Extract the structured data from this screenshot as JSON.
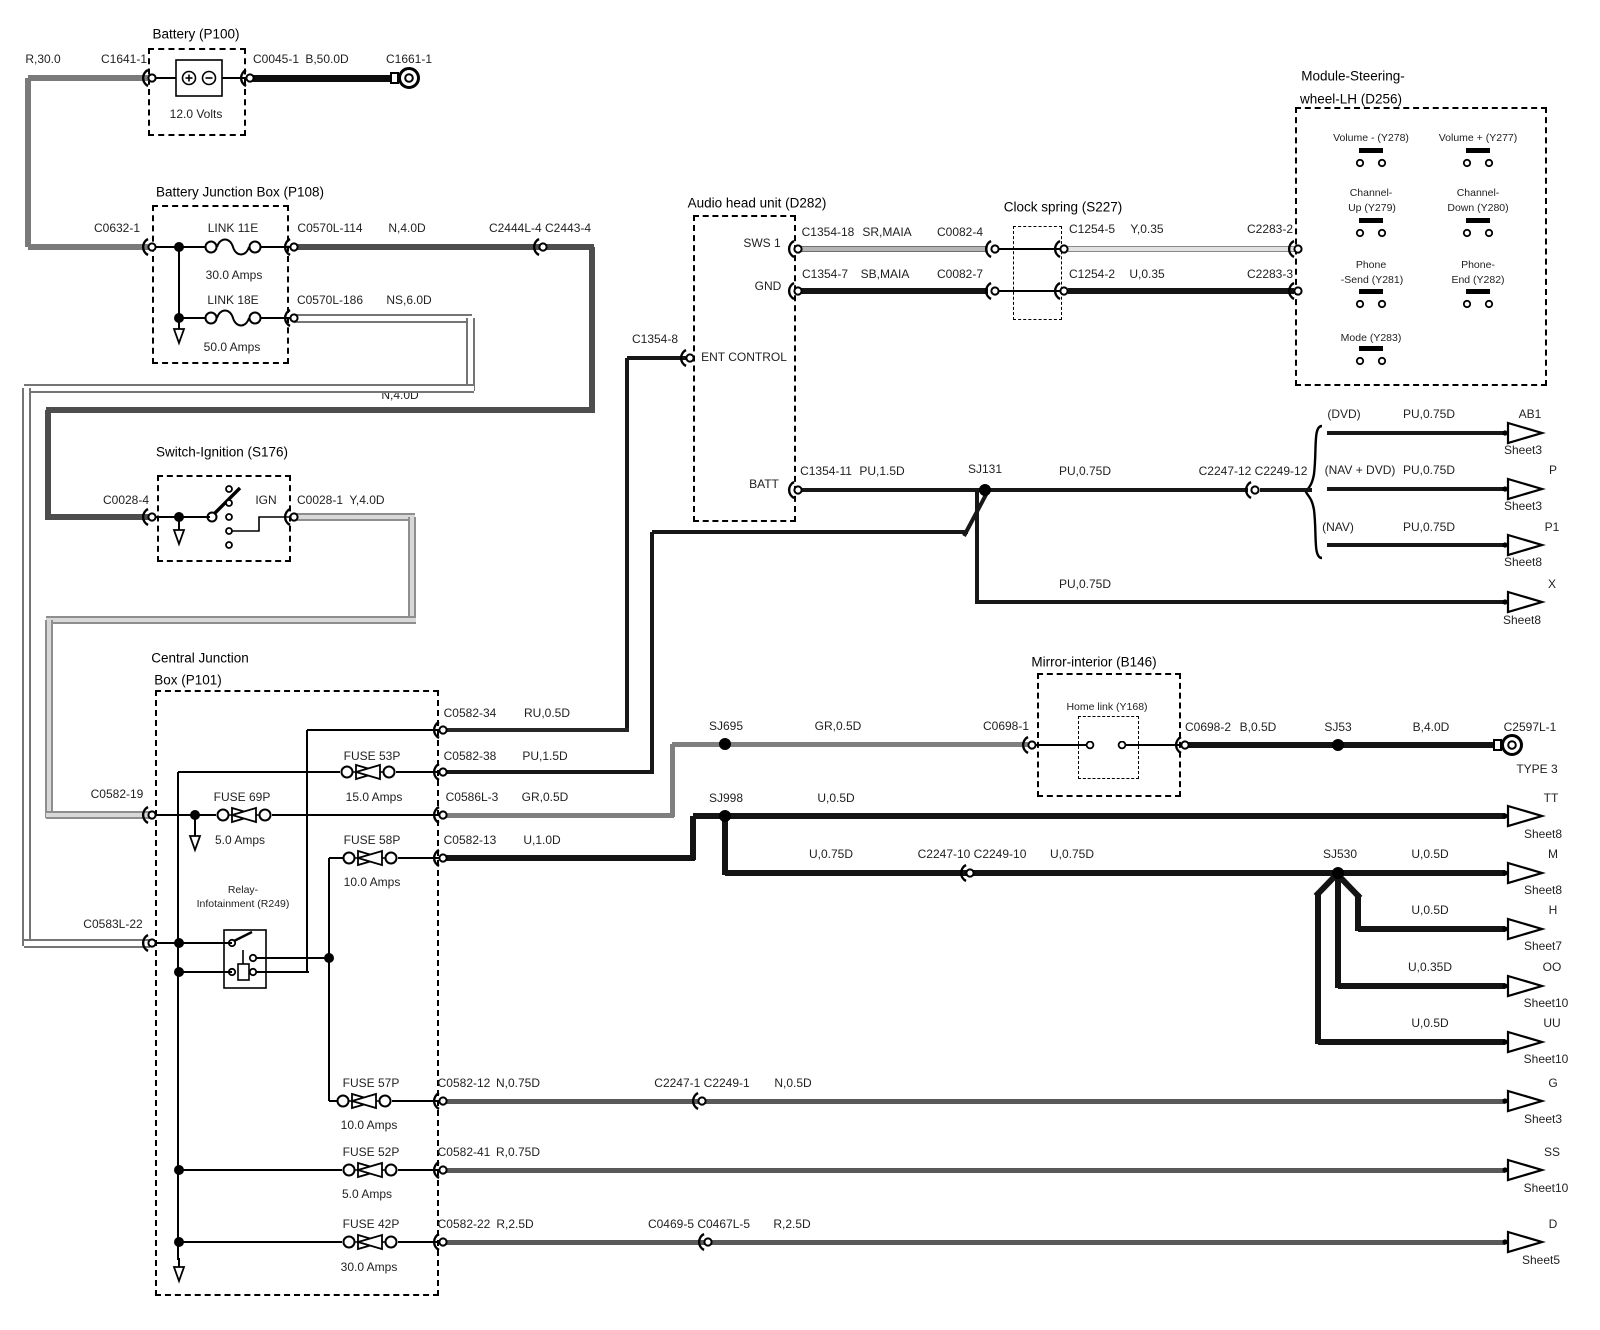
{
  "diagram_title": "Audio system power / steering wheel controls wiring diagram",
  "labels": [
    {
      "n": "wire-label-r30",
      "t": "R,30.0",
      "x": 43,
      "y": 59
    },
    {
      "n": "connector-label-c1641-1",
      "t": "C1641-1",
      "x": 124,
      "y": 59
    },
    {
      "n": "battery-title",
      "t": "Battery (P100)",
      "x": 196,
      "y": 34,
      "c": "t"
    },
    {
      "n": "connector-label-c0045-1",
      "t": "C0045-1",
      "x": 276,
      "y": 59
    },
    {
      "n": "wire-label-b50",
      "t": "B,50.0D",
      "x": 327,
      "y": 59
    },
    {
      "n": "connector-label-c1661-1",
      "t": "C1661-1",
      "x": 409,
      "y": 59
    },
    {
      "n": "battery-voltage",
      "t": "12.0 Volts",
      "x": 196,
      "y": 114
    },
    {
      "n": "bjb-title",
      "t": "Battery Junction Box (P108)",
      "x": 240,
      "y": 192,
      "c": "t"
    },
    {
      "n": "connector-label-c0632-1",
      "t": "C0632-1",
      "x": 117,
      "y": 228
    },
    {
      "n": "link11e-label",
      "t": "LINK 11E",
      "x": 233,
      "y": 228
    },
    {
      "n": "connector-label-c0570l-114",
      "t": "C0570L-114",
      "x": 330,
      "y": 228
    },
    {
      "n": "wire-label-n4-1",
      "t": "N,4.0D",
      "x": 407,
      "y": 228
    },
    {
      "n": "connector-label-c2444l-4",
      "t": "C2444L-4 C2443-4",
      "x": 540,
      "y": 228
    },
    {
      "n": "link11e-amps",
      "t": "30.0 Amps",
      "x": 234,
      "y": 275
    },
    {
      "n": "link18e-label",
      "t": "LINK 18E",
      "x": 233,
      "y": 300
    },
    {
      "n": "connector-label-c0570l-186",
      "t": "C0570L-186",
      "x": 330,
      "y": 300
    },
    {
      "n": "wire-label-ns6",
      "t": "NS,6.0D",
      "x": 409,
      "y": 300
    },
    {
      "n": "link18e-amps",
      "t": "50.0 Amps",
      "x": 232,
      "y": 347
    },
    {
      "n": "wire-label-n4-2",
      "t": "N,4.0D",
      "x": 400,
      "y": 395
    },
    {
      "n": "ignition-title",
      "t": "Switch-Ignition (S176)",
      "x": 222,
      "y": 452,
      "c": "t"
    },
    {
      "n": "connector-label-c0028-4",
      "t": "C0028-4",
      "x": 126,
      "y": 500
    },
    {
      "n": "ign-label",
      "t": "IGN",
      "x": 266,
      "y": 500
    },
    {
      "n": "connector-label-c0028-1",
      "t": "C0028-1",
      "x": 320,
      "y": 500
    },
    {
      "n": "wire-label-y4",
      "t": "Y,4.0D",
      "x": 367,
      "y": 500
    },
    {
      "n": "audio-title",
      "t": "Audio head unit (D282)",
      "x": 757,
      "y": 203,
      "c": "t"
    },
    {
      "n": "pin-label-sws1",
      "t": "SWS 1",
      "x": 762,
      "y": 243
    },
    {
      "n": "connector-label-c1354-18",
      "t": "C1354-18",
      "x": 828,
      "y": 232
    },
    {
      "n": "wire-label-sr-maia",
      "t": "SR,MAIA",
      "x": 887,
      "y": 232
    },
    {
      "n": "connector-label-c0082-4",
      "t": "C0082-4",
      "x": 960,
      "y": 232
    },
    {
      "n": "pin-label-gnd",
      "t": "GND",
      "x": 768,
      "y": 286
    },
    {
      "n": "connector-label-c1354-7",
      "t": "C1354-7",
      "x": 825,
      "y": 274
    },
    {
      "n": "wire-label-sb-maia",
      "t": "SB,MAIA",
      "x": 885,
      "y": 274
    },
    {
      "n": "connector-label-c0082-7",
      "t": "C0082-7",
      "x": 960,
      "y": 274
    },
    {
      "n": "clockspring-title",
      "t": "Clock spring (S227)",
      "x": 1063,
      "y": 207,
      "c": "t"
    },
    {
      "n": "connector-label-c1254-5",
      "t": "C1254-5",
      "x": 1092,
      "y": 229
    },
    {
      "n": "wire-label-y035",
      "t": "Y,0.35",
      "x": 1147,
      "y": 229
    },
    {
      "n": "connector-label-c2283-2",
      "t": "C2283-2",
      "x": 1270,
      "y": 229
    },
    {
      "n": "connector-label-c1254-2",
      "t": "C1254-2",
      "x": 1092,
      "y": 274
    },
    {
      "n": "wire-label-u035",
      "t": "U,0.35",
      "x": 1147,
      "y": 274
    },
    {
      "n": "connector-label-c2283-3",
      "t": "C2283-3",
      "x": 1270,
      "y": 274
    },
    {
      "n": "module-title-1",
      "t": "Module-Steering-",
      "x": 1353,
      "y": 76,
      "c": "t"
    },
    {
      "n": "module-title-2",
      "t": "wheel-LH (D256)",
      "x": 1351,
      "y": 99,
      "c": "t"
    },
    {
      "n": "btn-volume-minus-label",
      "t": "Volume - (Y278)",
      "x": 1371,
      "y": 138,
      "c": "sm"
    },
    {
      "n": "btn-volume-plus-label",
      "t": "Volume + (Y277)",
      "x": 1478,
      "y": 138,
      "c": "sm"
    },
    {
      "n": "btn-channel-up-label-1",
      "t": "Channel-",
      "x": 1371,
      "y": 193,
      "c": "sm"
    },
    {
      "n": "btn-channel-up-label-2",
      "t": "Up (Y279)",
      "x": 1372,
      "y": 208,
      "c": "sm"
    },
    {
      "n": "btn-channel-down-label-1",
      "t": "Channel-",
      "x": 1478,
      "y": 193,
      "c": "sm"
    },
    {
      "n": "btn-channel-down-label-2",
      "t": "Down (Y280)",
      "x": 1478,
      "y": 208,
      "c": "sm"
    },
    {
      "n": "btn-phone-send-label-1",
      "t": "Phone",
      "x": 1371,
      "y": 265,
      "c": "sm"
    },
    {
      "n": "btn-phone-send-label-2",
      "t": "-Send (Y281)",
      "x": 1372,
      "y": 280,
      "c": "sm"
    },
    {
      "n": "btn-phone-end-label-1",
      "t": "Phone-",
      "x": 1478,
      "y": 265,
      "c": "sm"
    },
    {
      "n": "btn-phone-end-label-2",
      "t": "End (Y282)",
      "x": 1478,
      "y": 280,
      "c": "sm"
    },
    {
      "n": "btn-mode-label",
      "t": "Mode (Y283)",
      "x": 1371,
      "y": 338,
      "c": "sm"
    },
    {
      "n": "connector-label-c1354-8",
      "t": "C1354-8",
      "x": 655,
      "y": 339
    },
    {
      "n": "pin-label-ent-control",
      "t": "ENT CONTROL",
      "x": 744,
      "y": 357
    },
    {
      "n": "pin-label-batt",
      "t": "BATT",
      "x": 764,
      "y": 484
    },
    {
      "n": "connector-label-c1354-11",
      "t": "C1354-11",
      "x": 826,
      "y": 471
    },
    {
      "n": "wire-label-pu15",
      "t": "PU,1.5D",
      "x": 882,
      "y": 471
    },
    {
      "n": "splice-label-sj131",
      "t": "SJ131",
      "x": 985,
      "y": 469
    },
    {
      "n": "wire-label-pu075-main",
      "t": "PU,0.75D",
      "x": 1085,
      "y": 471
    },
    {
      "n": "connector-label-c2247-12",
      "t": "C2247-12 C2249-12",
      "x": 1253,
      "y": 471
    },
    {
      "n": "branch-label-dvd",
      "t": "(DVD)",
      "x": 1344,
      "y": 414
    },
    {
      "n": "wire-label-pu075-dvd",
      "t": "PU,0.75D",
      "x": 1429,
      "y": 414
    },
    {
      "n": "ref-ab1",
      "t": "AB1",
      "x": 1530,
      "y": 414
    },
    {
      "n": "ref-ab1-sheet",
      "t": "Sheet3",
      "x": 1523,
      "y": 450
    },
    {
      "n": "branch-label-nav-dvd",
      "t": "(NAV + DVD)",
      "x": 1360,
      "y": 470
    },
    {
      "n": "wire-label-pu075-navdvd",
      "t": "PU,0.75D",
      "x": 1429,
      "y": 470
    },
    {
      "n": "ref-p",
      "t": "P",
      "x": 1553,
      "y": 470
    },
    {
      "n": "ref-p-sheet",
      "t": "Sheet3",
      "x": 1523,
      "y": 506
    },
    {
      "n": "branch-label-nav",
      "t": "(NAV)",
      "x": 1338,
      "y": 527
    },
    {
      "n": "wire-label-pu075-nav",
      "t": "PU,0.75D",
      "x": 1429,
      "y": 527
    },
    {
      "n": "ref-p1",
      "t": "P1",
      "x": 1552,
      "y": 527
    },
    {
      "n": "ref-p1-sheet",
      "t": "Sheet8",
      "x": 1523,
      "y": 562
    },
    {
      "n": "wire-label-pu075-x",
      "t": "PU,0.75D",
      "x": 1085,
      "y": 584
    },
    {
      "n": "ref-x",
      "t": "X",
      "x": 1552,
      "y": 584
    },
    {
      "n": "ref-x-sheet",
      "t": "Sheet8",
      "x": 1522,
      "y": 620
    },
    {
      "n": "cjb-title-1",
      "t": "Central Junction",
      "x": 200,
      "y": 658,
      "c": "t"
    },
    {
      "n": "cjb-title-2",
      "t": "Box (P101)",
      "x": 188,
      "y": 680,
      "c": "t"
    },
    {
      "n": "connector-label-c0582-34",
      "t": "C0582-34",
      "x": 470,
      "y": 713
    },
    {
      "n": "wire-label-ru05",
      "t": "RU,0.5D",
      "x": 547,
      "y": 713
    },
    {
      "n": "fuse53p-label",
      "t": "FUSE 53P",
      "x": 372,
      "y": 756
    },
    {
      "n": "connector-label-c0582-38",
      "t": "C0582-38",
      "x": 470,
      "y": 756
    },
    {
      "n": "wire-label-pu15d",
      "t": "PU,1.5D",
      "x": 545,
      "y": 756
    },
    {
      "n": "fuse69p-label",
      "t": "FUSE 69P",
      "x": 242,
      "y": 797
    },
    {
      "n": "fuse53p-amps",
      "t": "15.0 Amps",
      "x": 374,
      "y": 797
    },
    {
      "n": "connector-label-c0586l-3",
      "t": "C0586L-3",
      "x": 472,
      "y": 797
    },
    {
      "n": "wire-label-gr05",
      "t": "GR,0.5D",
      "x": 545,
      "y": 797
    },
    {
      "n": "connector-label-c0582-19",
      "t": "C0582-19",
      "x": 117,
      "y": 794
    },
    {
      "n": "fuse69p-amps",
      "t": "5.0 Amps",
      "x": 240,
      "y": 840
    },
    {
      "n": "fuse58p-label",
      "t": "FUSE 58P",
      "x": 372,
      "y": 840
    },
    {
      "n": "connector-label-c0582-13",
      "t": "C0582-13",
      "x": 470,
      "y": 840
    },
    {
      "n": "wire-label-u10",
      "t": "U,1.0D",
      "x": 542,
      "y": 840
    },
    {
      "n": "fuse58p-amps",
      "t": "10.0 Amps",
      "x": 372,
      "y": 882
    },
    {
      "n": "relay-title-1",
      "t": "Relay-",
      "x": 243,
      "y": 890,
      "c": "sm"
    },
    {
      "n": "relay-title-2",
      "t": "Infotainment (R249)",
      "x": 243,
      "y": 904,
      "c": "sm"
    },
    {
      "n": "connector-label-c0583l-22",
      "t": "C0583L-22",
      "x": 113,
      "y": 924
    },
    {
      "n": "splice-label-sj695",
      "t": "SJ695",
      "x": 726,
      "y": 726
    },
    {
      "n": "wire-label-gr05-2",
      "t": "GR,0.5D",
      "x": 838,
      "y": 726
    },
    {
      "n": "connector-label-c0698-1",
      "t": "C0698-1",
      "x": 1006,
      "y": 726
    },
    {
      "n": "splice-label-sj998",
      "t": "SJ998",
      "x": 726,
      "y": 798
    },
    {
      "n": "wire-label-u05-tt",
      "t": "U,0.5D",
      "x": 836,
      "y": 798
    },
    {
      "n": "wire-label-u075-1",
      "t": "U,0.75D",
      "x": 831,
      "y": 854
    },
    {
      "n": "connector-label-c2247-10",
      "t": "C2247-10 C2249-10",
      "x": 972,
      "y": 854
    },
    {
      "n": "wire-label-u075-2",
      "t": "U,0.75D",
      "x": 1072,
      "y": 854
    },
    {
      "n": "mirror-title",
      "t": "Mirror-interior (B146)",
      "x": 1094,
      "y": 662,
      "c": "t"
    },
    {
      "n": "homelink-label",
      "t": "Home link (Y168)",
      "x": 1107,
      "y": 707,
      "c": "sm"
    },
    {
      "n": "connector-label-c0698-2",
      "t": "C0698-2",
      "x": 1208,
      "y": 727
    },
    {
      "n": "wire-label-b05",
      "t": "B,0.5D",
      "x": 1258,
      "y": 727
    },
    {
      "n": "splice-label-sj53",
      "t": "SJ53",
      "x": 1338,
      "y": 727
    },
    {
      "n": "wire-label-b40",
      "t": "B,4.0D",
      "x": 1431,
      "y": 727
    },
    {
      "n": "connector-label-c2597l-1",
      "t": "C2597L-1",
      "x": 1530,
      "y": 727
    },
    {
      "n": "ground-type-label",
      "t": "TYPE 3",
      "x": 1537,
      "y": 769
    },
    {
      "n": "ref-tt",
      "t": "TT",
      "x": 1551,
      "y": 798
    },
    {
      "n": "ref-tt-sheet",
      "t": "Sheet8",
      "x": 1543,
      "y": 834
    },
    {
      "n": "splice-label-sj530",
      "t": "SJ530",
      "x": 1340,
      "y": 854
    },
    {
      "n": "wire-label-u05-m",
      "t": "U,0.5D",
      "x": 1430,
      "y": 854
    },
    {
      "n": "ref-m",
      "t": "M",
      "x": 1553,
      "y": 854
    },
    {
      "n": "ref-m-sheet",
      "t": "Sheet8",
      "x": 1543,
      "y": 890
    },
    {
      "n": "wire-label-u05-h",
      "t": "U,0.5D",
      "x": 1430,
      "y": 910
    },
    {
      "n": "ref-h",
      "t": "H",
      "x": 1553,
      "y": 910
    },
    {
      "n": "ref-h-sheet",
      "t": "Sheet7",
      "x": 1543,
      "y": 946
    },
    {
      "n": "wire-label-u035d",
      "t": "U,0.35D",
      "x": 1430,
      "y": 967
    },
    {
      "n": "ref-oo",
      "t": "OO",
      "x": 1552,
      "y": 967
    },
    {
      "n": "ref-oo-sheet",
      "t": "Sheet10",
      "x": 1546,
      "y": 1003
    },
    {
      "n": "wire-label-u05-uu",
      "t": "U,0.5D",
      "x": 1430,
      "y": 1023
    },
    {
      "n": "ref-uu",
      "t": "UU",
      "x": 1552,
      "y": 1023
    },
    {
      "n": "ref-uu-sheet",
      "t": "Sheet10",
      "x": 1546,
      "y": 1059
    },
    {
      "n": "fuse57p-label",
      "t": "FUSE 57P",
      "x": 371,
      "y": 1083
    },
    {
      "n": "connector-label-c0582-12",
      "t": "C0582-12",
      "x": 464,
      "y": 1083
    },
    {
      "n": "wire-label-n075",
      "t": "N,0.75D",
      "x": 518,
      "y": 1083
    },
    {
      "n": "connector-label-c2247-1",
      "t": "C2247-1 C2249-1",
      "x": 702,
      "y": 1083
    },
    {
      "n": "wire-label-n05",
      "t": "N,0.5D",
      "x": 793,
      "y": 1083
    },
    {
      "n": "fuse57p-amps",
      "t": "10.0 Amps",
      "x": 369,
      "y": 1125
    },
    {
      "n": "ref-g",
      "t": "G",
      "x": 1553,
      "y": 1083
    },
    {
      "n": "ref-g-sheet",
      "t": "Sheet3",
      "x": 1543,
      "y": 1119
    },
    {
      "n": "fuse52p-label",
      "t": "FUSE 52P",
      "x": 371,
      "y": 1152
    },
    {
      "n": "connector-label-c0582-41",
      "t": "C0582-41",
      "x": 464,
      "y": 1152
    },
    {
      "n": "wire-label-r075",
      "t": "R,0.75D",
      "x": 518,
      "y": 1152
    },
    {
      "n": "fuse52p-amps",
      "t": "5.0 Amps",
      "x": 367,
      "y": 1194
    },
    {
      "n": "ref-ss",
      "t": "SS",
      "x": 1552,
      "y": 1152
    },
    {
      "n": "ref-ss-sheet",
      "t": "Sheet10",
      "x": 1546,
      "y": 1188
    },
    {
      "n": "fuse42p-label",
      "t": "FUSE 42P",
      "x": 371,
      "y": 1224
    },
    {
      "n": "connector-label-c0582-22",
      "t": "C0582-22",
      "x": 464,
      "y": 1224
    },
    {
      "n": "wire-label-r25-1",
      "t": "R,2.5D",
      "x": 515,
      "y": 1224
    },
    {
      "n": "connector-label-c0469-5",
      "t": "C0469-5 C0467L-5",
      "x": 699,
      "y": 1224
    },
    {
      "n": "wire-label-r25-2",
      "t": "R,2.5D",
      "x": 792,
      "y": 1224
    },
    {
      "n": "fuse42p-amps",
      "t": "30.0 Amps",
      "x": 369,
      "y": 1267
    },
    {
      "n": "ref-d",
      "t": "D",
      "x": 1553,
      "y": 1224
    },
    {
      "n": "ref-d-sheet",
      "t": "Sheet5",
      "x": 1541,
      "y": 1260
    }
  ]
}
